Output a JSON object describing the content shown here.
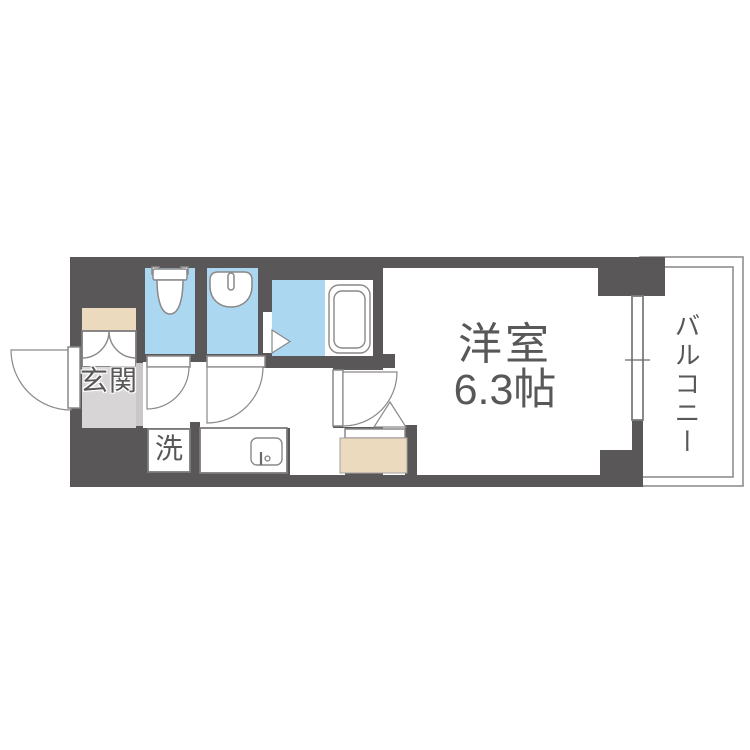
{
  "floorplan": {
    "labels": {
      "entrance": "玄関",
      "laundry": "洗",
      "room_name": "洋室",
      "room_size": "6.3帖",
      "balcony": "バルコニー"
    },
    "colors": {
      "wall": "#595757",
      "water_blue": "#abd7f0",
      "beige": "#ecdabf",
      "entrance_floor": "#d7d5d5",
      "entrance_strip": "#c9c7c7",
      "fixture_line": "#8a8888",
      "box_line": "#7d7b7b",
      "balcony_line": "#8f8d8d",
      "text": "#595757"
    }
  }
}
